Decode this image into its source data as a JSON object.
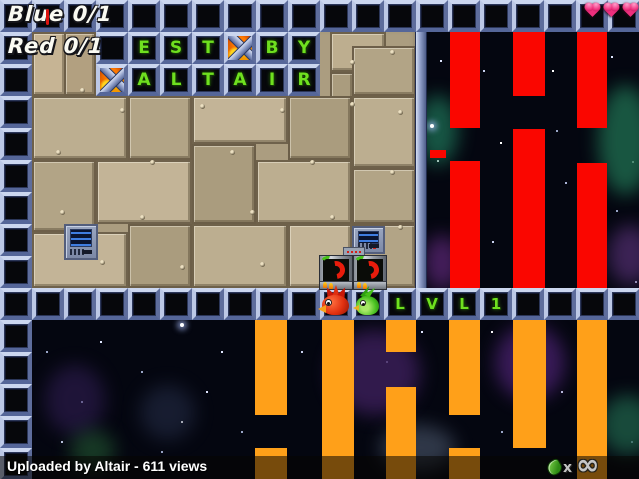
{
  "hud": {
    "blue_score": "Blue 0/1",
    "red_score": "Red 0/1",
    "health_hearts": 3,
    "ammo_multiplier": "x",
    "ammo_count": "∞"
  },
  "sign": {
    "row1": [
      "E",
      "S",
      "T",
      "B",
      "Y"
    ],
    "row2": [
      "A",
      "L",
      "T",
      "A",
      "I",
      "R"
    ],
    "lvl": [
      "L",
      "V",
      "L",
      "1"
    ]
  },
  "caption": {
    "text": "Uploaded by Altair - 611 views"
  },
  "icons": {
    "fire_cross_tile": "fire-x-tile-icon",
    "heart": "heart-icon",
    "ammo": "green-ammo-icon"
  },
  "colors": {
    "red_bar": "#fa0600",
    "orange_bar": "#ffa019",
    "letter_green": "#6fe01f",
    "heart_pink": "#ee2f7d",
    "space_bg": "#040610"
  }
}
